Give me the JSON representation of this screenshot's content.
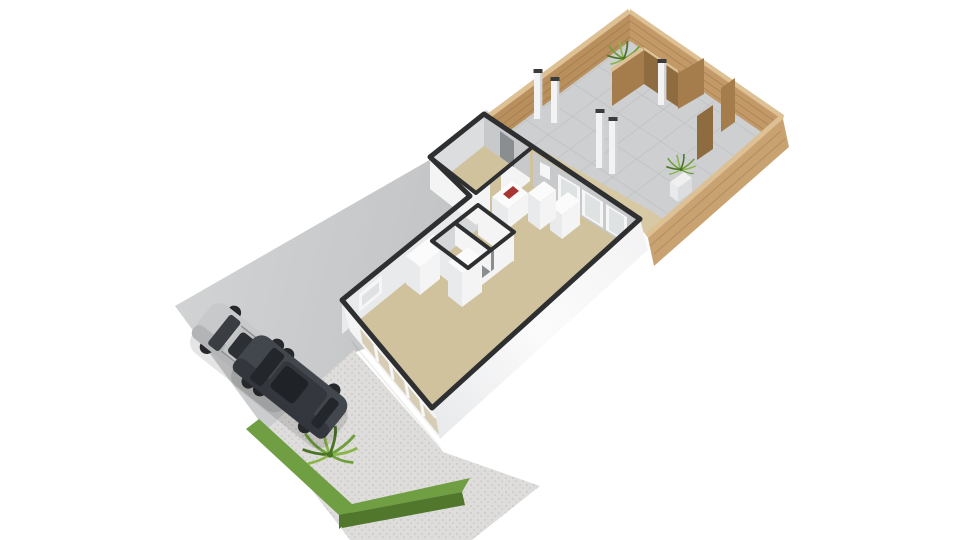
{
  "scene": {
    "kind": "isometric-3d-floorplan-render",
    "background": "#ffffff",
    "elements": [
      "backyard-patio",
      "wooden-fence",
      "privacy-screens",
      "pergola-posts",
      "garden-plants",
      "planter",
      "house",
      "utility-room",
      "hallway",
      "bathroom",
      "kitchen",
      "living-room",
      "kitchen-counter",
      "cooktop",
      "cabinets",
      "sliding-glass-doors",
      "front-window-band",
      "driveway",
      "silver-suv",
      "dark-suv",
      "gravel-area",
      "hedge",
      "palm-plant"
    ]
  },
  "palette": {
    "background": "#ffffff",
    "driveway_light": "#d1d2d3",
    "driveway_dark": "#bcbec0",
    "gravel": "#dedddb",
    "gravel_dot": "#c3c3c0",
    "hedge_top": "#6f9e43",
    "hedge_side": "#50772c",
    "palm_dark": "#4a7326",
    "palm_mid": "#6f9e3c",
    "palm_light": "#8ab54a",
    "patio": "#cdcfd0",
    "patio_line": "#bbbdbf",
    "path": "#d6c9a3",
    "fence_nw": "#b9905d",
    "fence_ne": "#c39a67",
    "fence_se": "#c9a271",
    "fence_top": "#ddc094",
    "fence_dark": "#8f6b40",
    "fence_mid": "#a57d4c",
    "plank": "#6b4f2e",
    "post_white": "#f3f3f3",
    "post_shade": "#d2d3d4",
    "post_cap": "#3b3b3c",
    "floor": "#cfc29d",
    "cap": "#2e2f30",
    "wall_white": "#f4f4f5",
    "wall_light": "#fbfbfc",
    "wall_med": "#e9eaeb",
    "wall_soft": "#dcdddf",
    "wall_dark": "#c7c9cb",
    "wall_shadow": "#d6d7d8",
    "glass": "#dfe2e2",
    "glass_warm": "#d6cdb4",
    "frame": "#f6f6f7",
    "door_dark": "#8b8e90",
    "cooktop_red": "#a83434",
    "planter_white": "#f0f0f0",
    "car1_body": "#c8c9ca",
    "car1_shade": "#b2b4b6",
    "car1_roof": "#c2c3c5",
    "car1_glass": "#3a3e43",
    "car1_dark": "#2c2f33",
    "car1_detail": "#8e9092",
    "car2_body": "#42474e",
    "car2_shade": "#33373d",
    "car2_roof": "#34383e",
    "car2_glass": "#23262b",
    "car2_dark": "#1f2226",
    "wheel": "#26282b",
    "shadow": "#000000"
  }
}
